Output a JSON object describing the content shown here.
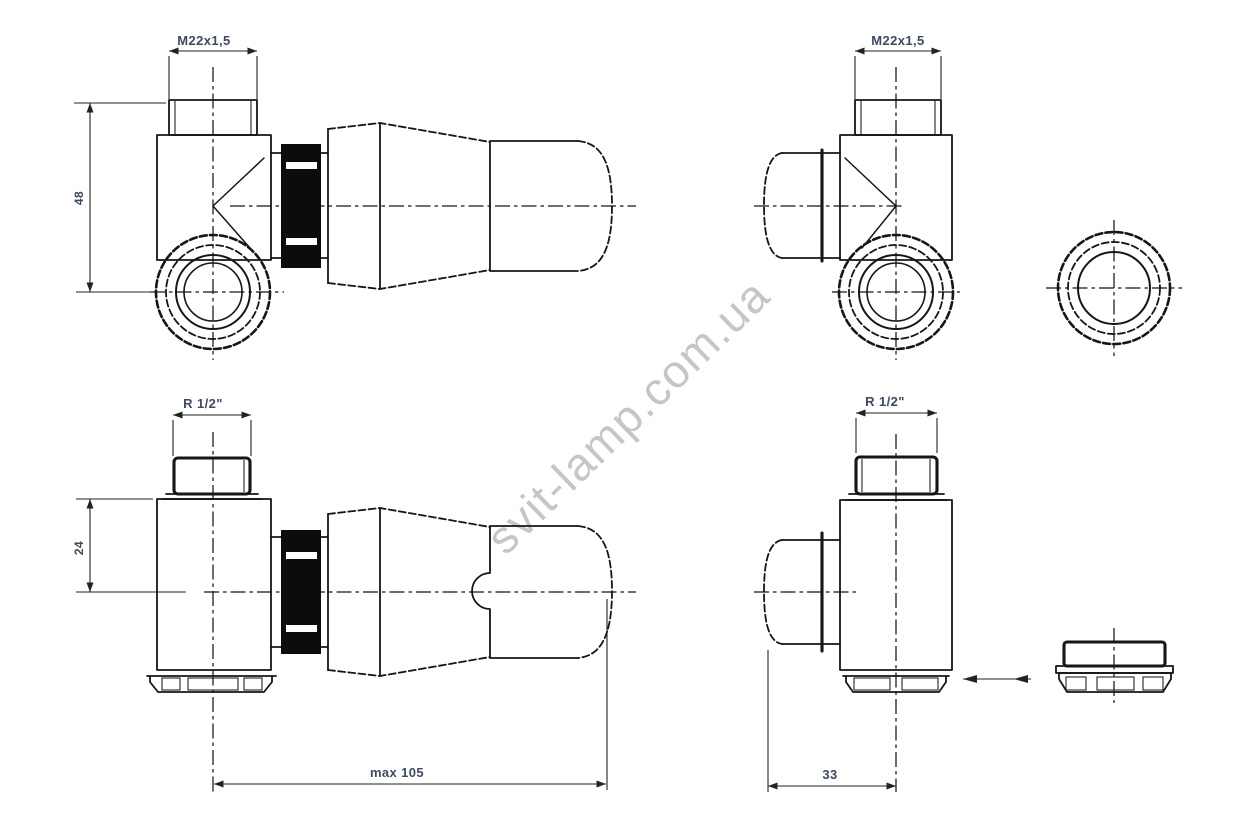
{
  "watermark": {
    "text": "svit-lamp.com.ua"
  },
  "colors": {
    "line": "#161616",
    "dimension_text": "#3e4a5e",
    "watermark": "#c6c6c6",
    "coupling_nut_fill": "#0c0c0c",
    "background": "#ffffff"
  },
  "views": {
    "top_left": {
      "thread_label": "M22x1,5",
      "height_dim": "48"
    },
    "top_right": {
      "thread_label": "M22x1,5"
    },
    "bottom_left": {
      "thread_label": "R 1/2\"",
      "offset_dim": "24",
      "length_dim": "max 105"
    },
    "bottom_right": {
      "thread_label": "R 1/2\"",
      "offset_dim": "33"
    }
  }
}
